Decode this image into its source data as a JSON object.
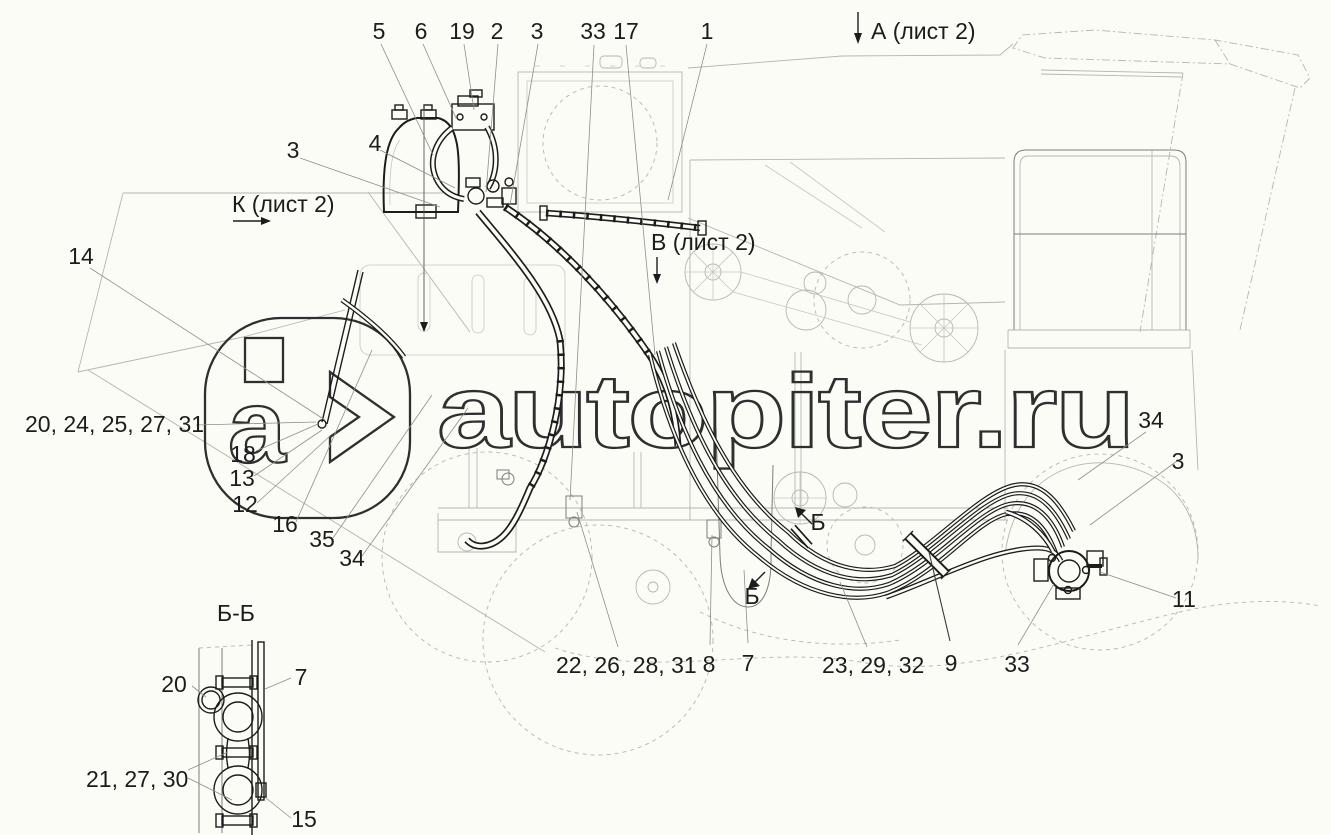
{
  "watermark": {
    "text": "autopiter.ru",
    "logo_letter": "a"
  },
  "views": {
    "a": "А (лист 2)",
    "k": "К (лист 2)",
    "v": "В (лист 2)",
    "section_title": "Б-Б",
    "marker": "Б"
  },
  "callouts": {
    "top": [
      "5",
      "6",
      "19",
      "2",
      "3",
      "33",
      "17",
      "1"
    ],
    "left": [
      "3",
      "4",
      "14"
    ],
    "cluster_left": "20, 24, 25, 27, 31",
    "logo_stack": [
      "18",
      "13",
      "12",
      "16",
      "35",
      "34"
    ],
    "right": [
      "34",
      "3",
      "11"
    ],
    "bottom": [
      "22, 26, 28, 31",
      "8",
      "7",
      "23, 29, 32",
      "9",
      "33"
    ],
    "detail": {
      "n20": "20",
      "n7": "7",
      "n21": "21, 27, 30",
      "n15": "15"
    }
  },
  "colors": {
    "ink": "#1c1c1c",
    "faint": "#b6b6b1",
    "leader": "#8f8f8a",
    "background": "#fcfcf7",
    "watermark": "#2f2f2f"
  }
}
